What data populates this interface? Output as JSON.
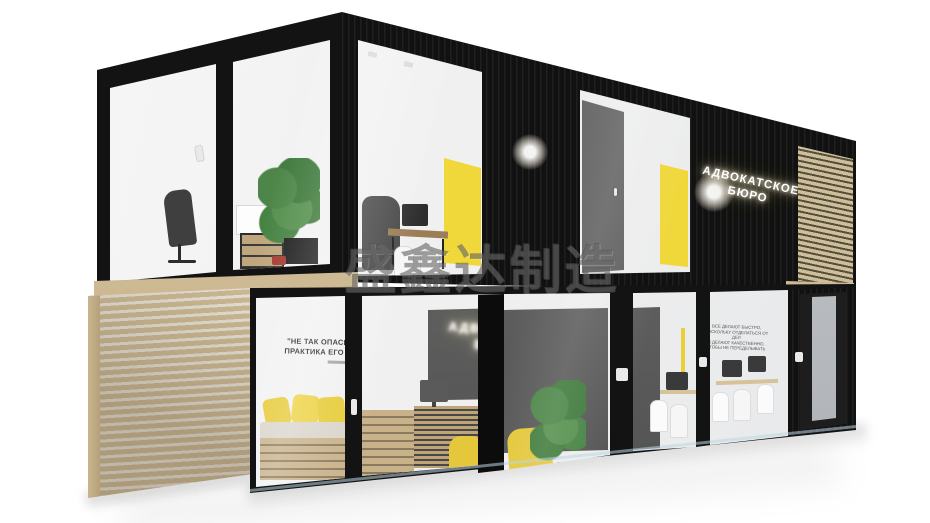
{
  "scene": {
    "type": "3d architectural render",
    "subject": "two-story modular shipping container office building with glass facades",
    "background_color": "#ffffff"
  },
  "watermark": {
    "text": "盛鑫达制造"
  },
  "upper_floor": {
    "neon_sign": {
      "line1": "АДВОКАТСКОЕ",
      "line2": "БЮРО"
    }
  },
  "lower_floor": {
    "wall_quote": {
      "line1": "\"НЕ ТАК ОПАСЕН ЗАКОН, КАК",
      "line2": "ПРАКТИКА ЕГО ПРИМЕНЕНИЯ\""
    },
    "interior_neon_sign": {
      "line1": "АДВОКАТСКОЕ",
      "line2": "БЮРО"
    },
    "glass_motto": {
      "line1": "ВСЕ ДЕЛАЮТ БЫСТРО,",
      "line2": "ПОСКОЛЬКУ ОТДЕЛАТЬСЯ ОТ ДЕЛ",
      "line3": "И ДЕЛАЮТ КАЧЕСТВЕННО,",
      "line4": "ЧТОБЫ НЕ ПЕРЕДЕЛЫВАТЬ"
    }
  },
  "colors": {
    "frame_black": "#131313",
    "corrugation_highlight": "#1f1f1f",
    "wood_light": "#d7c49e",
    "wood_dark": "#8a7a5e",
    "accent_yellow": "#f0d73a",
    "interior_white": "#f6f6f6",
    "partition_gray": "#5e5e5e",
    "plant_green": "#4a7f46",
    "accent_red": "#a8362f",
    "frosted_glass": "#b9bcc0"
  }
}
